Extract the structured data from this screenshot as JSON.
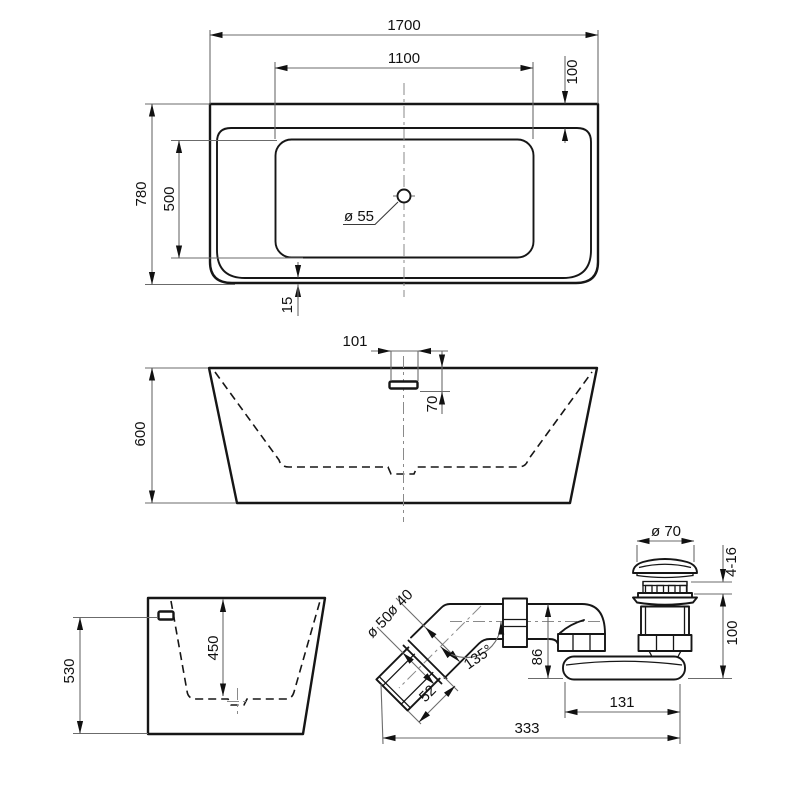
{
  "top_view": {
    "overall_length": "1700",
    "basin_length": "1100",
    "rear_ledge_depth": "100",
    "overall_width": "780",
    "basin_width": "500",
    "front_rim": "15",
    "drain_hole": "ø 55"
  },
  "front_view": {
    "overflow_offset": "101",
    "overflow_depth": "70",
    "overall_height": "600"
  },
  "side_view": {
    "overflow_height": "530",
    "inner_depth": "450"
  },
  "waste_kit": {
    "cap_diameter": "ø 70",
    "adjustment_range": "4-16",
    "drain_height": "100",
    "pipe_diameter": "ø 40",
    "outlet_diameter": "ø 50",
    "outlet_length": "52",
    "elbow_angle": "135°",
    "trap_height": "86",
    "body_length": "131",
    "overall_length": "333"
  }
}
